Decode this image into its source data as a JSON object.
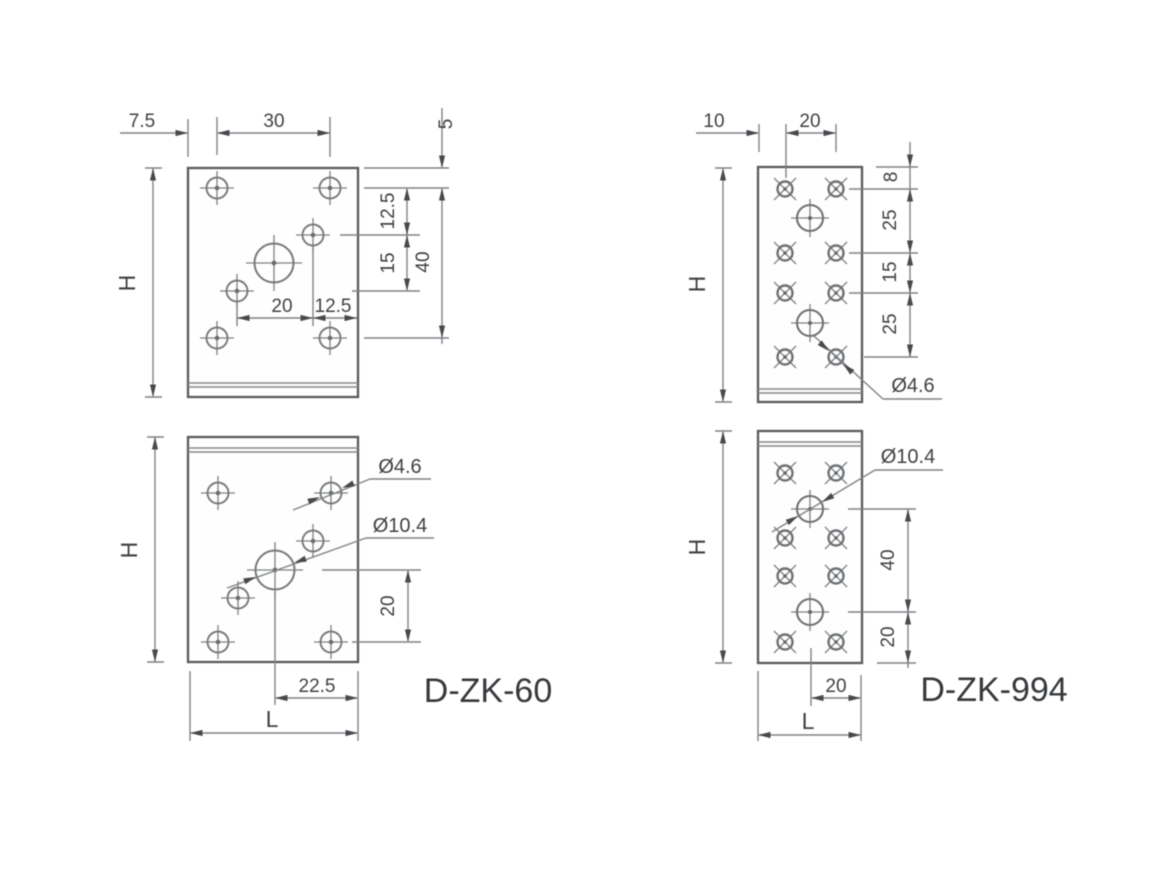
{
  "colors": {
    "background": "#ffffff",
    "line_gray": "#7f8285",
    "plate_edge_gray": "#575a5d",
    "text_gray": "#3e4144"
  },
  "parts": {
    "dzk60": {
      "name": "D-ZK-60",
      "top_view": {
        "edge_to_hole": "7.5",
        "hole_spacing": "30",
        "top_edge_to_row1": "5",
        "row1_to_mid_hole": "12.5",
        "mid_hole_vertical_gap": "15",
        "row1_to_row4": "40",
        "mid_hole_spacing": "20",
        "mid_hole_to_edge": "12.5",
        "height": "H"
      },
      "front_view": {
        "height": "H",
        "small_hole_dia": "Ø4.6",
        "large_hole_dia": "Ø10.4",
        "circle_to_bottom_row": "20",
        "circle_to_right_edge": "22.5",
        "width": "L"
      }
    },
    "dzk994": {
      "name": "D-ZK-994",
      "top_view": {
        "edge_to_hole": "10",
        "hole_spacing": "20",
        "top_edge_to_row1": "8",
        "row1_to_row2": "25",
        "row2_to_row3": "15",
        "row3_to_row4": "25",
        "height": "H",
        "small_hole_dia": "Ø4.6"
      },
      "front_view": {
        "height": "H",
        "large_hole_dia": "Ø10.4",
        "circle_spacing": "40",
        "circle_to_bottom": "20",
        "circle_to_right_edge": "20",
        "width": "L"
      }
    }
  }
}
